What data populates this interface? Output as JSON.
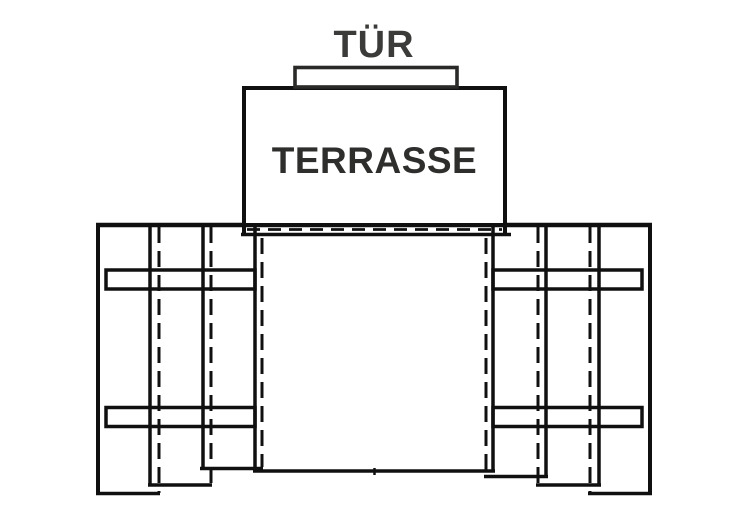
{
  "diagram": {
    "door_label": "TÜR",
    "terrace_label": "TERRASSE",
    "colors": {
      "background": "#ffffff",
      "line": "#101010",
      "door_label_color": "#3b3b39",
      "terrace_label_color": "#2e2e2c",
      "surface_fill": "#ffffff"
    }
  }
}
